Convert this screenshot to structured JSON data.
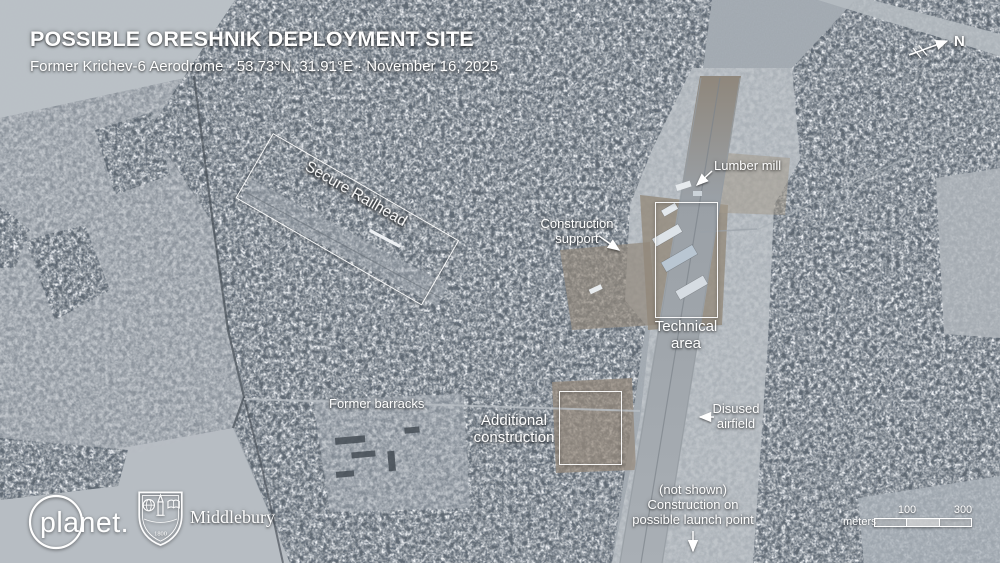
{
  "header": {
    "title": "POSSIBLE ORESHNIK DEPLOYMENT SITE",
    "subtitle": "Former Krichev-6 Aerodrome · 53.73°N, 31.91°E · November 16, 2025"
  },
  "compass": {
    "north_label": "N"
  },
  "annotations": {
    "secure_railhead": "Secure Railhead",
    "lumber_mill": "Lumber mill",
    "construction_support": "Construction\nsupport",
    "technical_area": "Technical\narea",
    "former_barracks": "Former barracks",
    "additional_construction": "Additional\nconstruction",
    "disused_airfield": "Disused\nairfield",
    "launch_point_note": "(not shown)\nConstruction on\npossible launch point"
  },
  "scale_bar": {
    "unit": "meters",
    "mid_tick": "100",
    "end_tick": "300"
  },
  "credits": {
    "planet_wordmark": "planet.",
    "middlebury_wordmark": "Middlebury",
    "middlebury_founding_year": "1800"
  },
  "colors": {
    "annotation": "#ffffff",
    "forest": "#5f6871",
    "field": "#b8bec4",
    "dirt": "#94897b"
  }
}
